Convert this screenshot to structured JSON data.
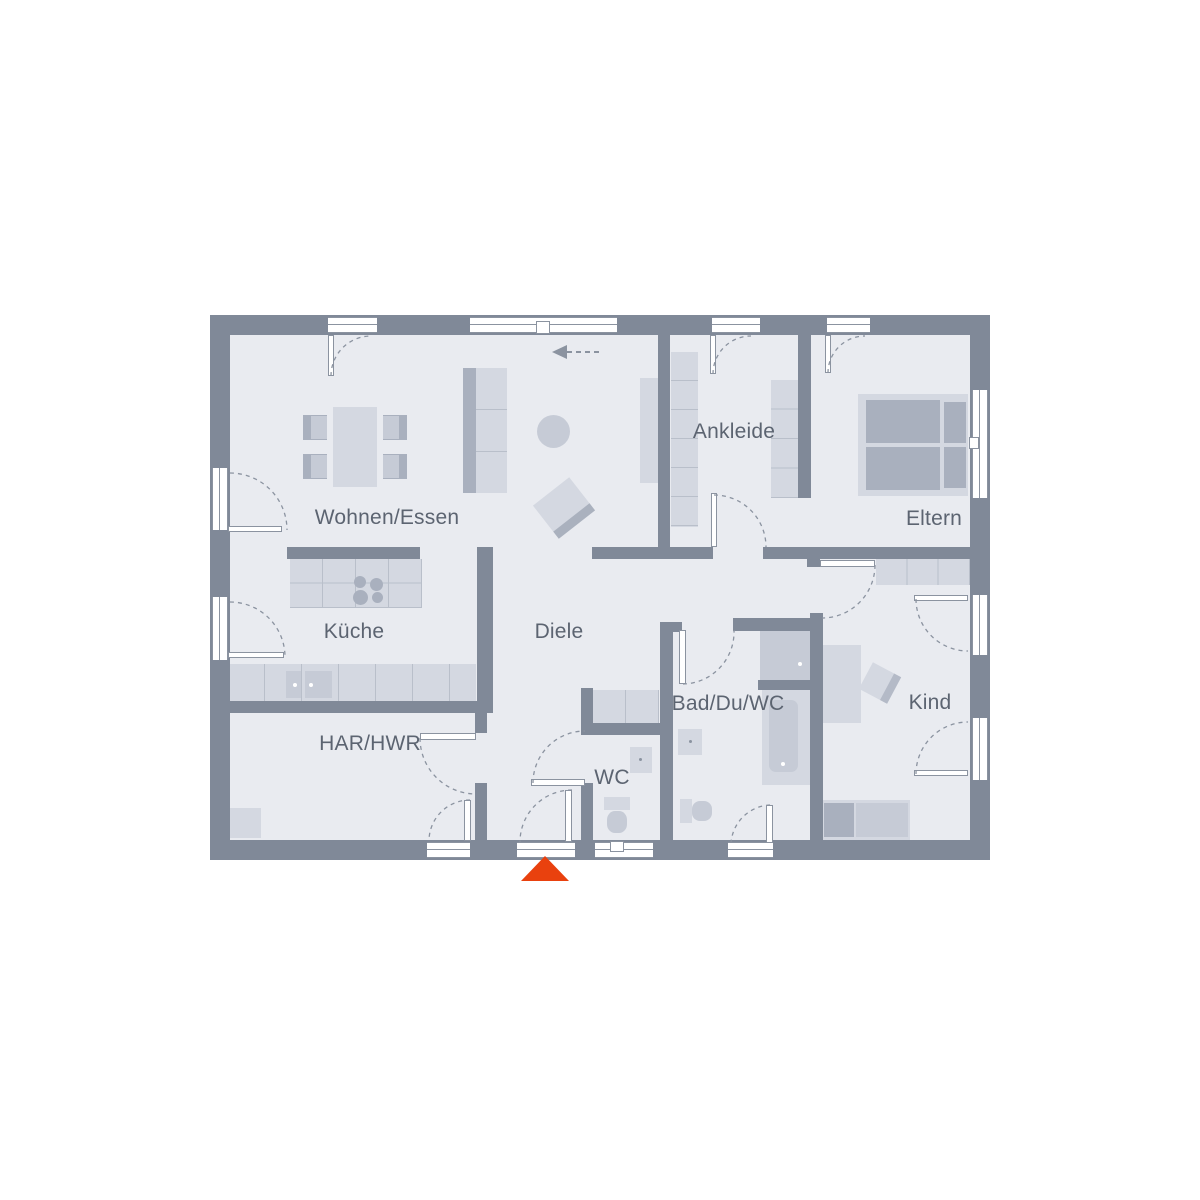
{
  "plan": {
    "type": "floor-plan",
    "rooms": [
      {
        "id": "wohnen-essen",
        "name": "Wohnen/Essen"
      },
      {
        "id": "kueche",
        "name": "Küche"
      },
      {
        "id": "diele",
        "name": "Diele"
      },
      {
        "id": "har-hwr",
        "name": "HAR/HWR"
      },
      {
        "id": "wc",
        "name": "WC"
      },
      {
        "id": "bad-du-wc",
        "name": "Bad/Du/WC"
      },
      {
        "id": "ankleide",
        "name": "Ankleide"
      },
      {
        "id": "eltern",
        "name": "Eltern"
      },
      {
        "id": "kind",
        "name": "Kind"
      }
    ],
    "icons": {
      "entrance": "entrance-arrow-triangle",
      "flow": "dashed-arrow-left"
    },
    "colors": {
      "wall": "#808998",
      "floor": "#e9ebf0",
      "furniture_light": "#d4d8e1",
      "furniture_mid": "#c6cbd6",
      "furniture_dark": "#a9b0be",
      "window": "#ffffff",
      "entrance_accent": "#e9410e",
      "label_text": "#5c6471"
    }
  }
}
